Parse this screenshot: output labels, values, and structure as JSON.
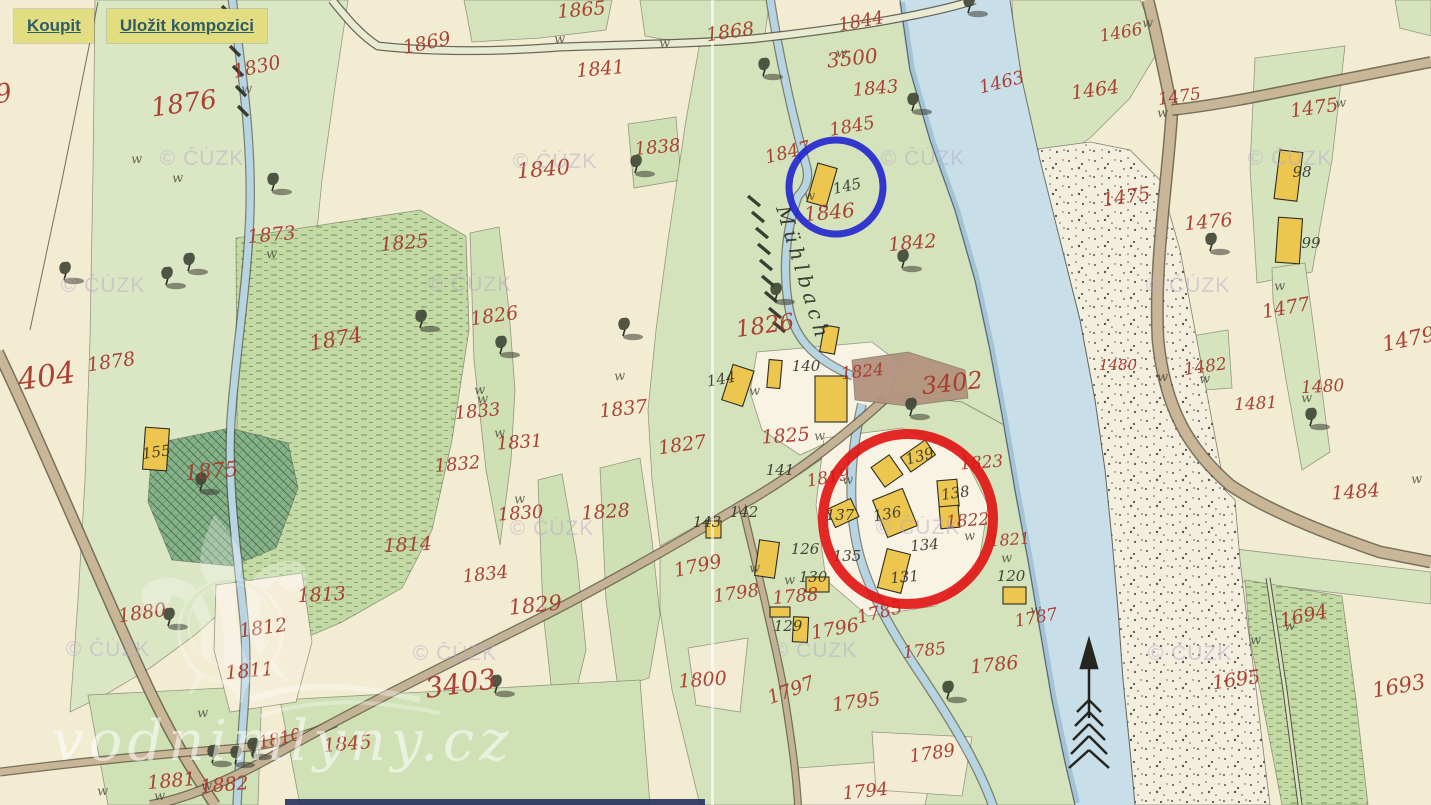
{
  "toolbar": {
    "buy_label": "Koupit",
    "save_label": "Uložit kompozici"
  },
  "map": {
    "stream_label": "Mühlbach",
    "watermark_small": "© ČÚZK",
    "watermark_large": "vodnimlyny.cz",
    "meadow_symbol": "w",
    "colors": {
      "annotation_blue": "#2023cf",
      "annotation_red": "#e01212",
      "parcel_red": "#a8392c",
      "building_yellow": "#ecc64e",
      "building_red": "#b34a56",
      "river_blue": "#c8dfe9"
    },
    "annotations": {
      "blue_circle": {
        "cx": 836,
        "cy": 187,
        "r": 47,
        "stroke_width": 7,
        "color": "#2023cf"
      },
      "red_circle": {
        "cx": 908,
        "cy": 519,
        "r": 85,
        "stroke_width": 10,
        "color": "#e01212"
      }
    },
    "red_parcels": [
      [
        "9",
        5,
        102,
        -10,
        26
      ],
      [
        "404",
        48,
        386,
        -8,
        30
      ],
      [
        "1876",
        185,
        112,
        -8,
        26
      ],
      [
        "1830",
        258,
        73,
        -12,
        19
      ],
      [
        "1873",
        272,
        241,
        -5,
        19
      ],
      [
        "1878",
        112,
        368,
        -8,
        19
      ],
      [
        "1875",
        212,
        478,
        -5,
        21
      ],
      [
        "1874",
        337,
        346,
        -10,
        21
      ],
      [
        "1880",
        143,
        619,
        -8,
        19
      ],
      [
        "1812",
        264,
        634,
        -8,
        19
      ],
      [
        "1811",
        250,
        677,
        -5,
        19
      ],
      [
        "1813",
        322,
        601,
        -3,
        19
      ],
      [
        "1881",
        172,
        787,
        -5,
        19
      ],
      [
        "1882",
        225,
        791,
        -5,
        19
      ],
      [
        "1810",
        281,
        744,
        -12,
        17
      ],
      [
        "3403",
        462,
        693,
        -8,
        28
      ],
      [
        "1845",
        348,
        750,
        -5,
        19
      ],
      [
        "1865",
        582,
        16,
        -5,
        19
      ],
      [
        "1869",
        428,
        49,
        -12,
        19
      ],
      [
        "1841",
        601,
        75,
        -5,
        19
      ],
      [
        "1868",
        731,
        38,
        -8,
        19
      ],
      [
        "1840",
        544,
        176,
        -5,
        21
      ],
      [
        "1838",
        658,
        153,
        -5,
        18
      ],
      [
        "1844",
        862,
        27,
        -10,
        18
      ],
      [
        "3500",
        853,
        65,
        -6,
        20
      ],
      [
        "1843",
        876,
        94,
        -5,
        18
      ],
      [
        "1845",
        853,
        132,
        -10,
        18
      ],
      [
        "1847",
        789,
        158,
        -14,
        18
      ],
      [
        "1846",
        830,
        219,
        -5,
        20
      ],
      [
        "1842",
        913,
        249,
        -5,
        19
      ],
      [
        "1825",
        405,
        249,
        -5,
        19
      ],
      [
        "1826",
        495,
        322,
        -8,
        19
      ],
      [
        "1826",
        766,
        333,
        -8,
        23
      ],
      [
        "1824",
        863,
        377,
        -6,
        17
      ],
      [
        "1825",
        786,
        442,
        -4,
        19
      ],
      [
        "1819",
        829,
        483,
        -10,
        17
      ],
      [
        "3402",
        953,
        391,
        -6,
        24
      ],
      [
        "1823",
        982,
        468,
        -4,
        17
      ],
      [
        "1822",
        968,
        526,
        -4,
        17
      ],
      [
        "1821",
        1010,
        545,
        -4,
        16
      ],
      [
        "1837",
        624,
        415,
        -6,
        19
      ],
      [
        "1827",
        683,
        451,
        -8,
        19
      ],
      [
        "1833",
        478,
        417,
        -5,
        18
      ],
      [
        "1831",
        520,
        448,
        -4,
        18
      ],
      [
        "1832",
        458,
        470,
        -5,
        18
      ],
      [
        "1830",
        521,
        519,
        -4,
        18
      ],
      [
        "1828",
        606,
        518,
        -4,
        19
      ],
      [
        "1834",
        486,
        580,
        -6,
        18
      ],
      [
        "1814",
        408,
        551,
        -3,
        19
      ],
      [
        "1829",
        536,
        612,
        -6,
        21
      ],
      [
        "1799",
        699,
        572,
        -12,
        19
      ],
      [
        "1798",
        737,
        599,
        -8,
        18
      ],
      [
        "1788",
        796,
        602,
        -5,
        18
      ],
      [
        "1796",
        836,
        635,
        -10,
        19
      ],
      [
        "1797",
        793,
        696,
        -20,
        19
      ],
      [
        "1795",
        857,
        708,
        -8,
        19
      ],
      [
        "1800",
        703,
        686,
        -4,
        19
      ],
      [
        "1785",
        881,
        618,
        -14,
        18
      ],
      [
        "1785",
        925,
        656,
        -6,
        17
      ],
      [
        "1786",
        995,
        671,
        -6,
        19
      ],
      [
        "1789",
        933,
        759,
        -8,
        18
      ],
      [
        "1794",
        866,
        797,
        -6,
        18
      ],
      [
        "1787",
        1037,
        623,
        -10,
        17
      ],
      [
        "1694",
        1305,
        622,
        -12,
        19
      ],
      [
        "1695",
        1237,
        686,
        -8,
        19
      ],
      [
        "1693",
        1400,
        693,
        -10,
        21
      ],
      [
        "1463",
        1003,
        88,
        -14,
        18
      ],
      [
        "1464",
        1096,
        96,
        -8,
        19
      ],
      [
        "1466",
        1122,
        38,
        -10,
        17
      ],
      [
        "1475",
        1180,
        102,
        -8,
        17
      ],
      [
        "1475",
        1315,
        114,
        -8,
        19
      ],
      [
        "1475",
        1127,
        203,
        -8,
        19
      ],
      [
        "1476",
        1209,
        228,
        -5,
        19
      ],
      [
        "1477",
        1287,
        314,
        -10,
        19
      ],
      [
        "1479",
        1410,
        346,
        -12,
        21
      ],
      [
        "1482",
        1206,
        372,
        -8,
        17
      ],
      [
        "1480",
        1118,
        370,
        0,
        15
      ],
      [
        "1480",
        1323,
        392,
        -3,
        17
      ],
      [
        "1481",
        1256,
        409,
        -3,
        17
      ],
      [
        "1484",
        1356,
        498,
        -4,
        19
      ]
    ],
    "black_numbers": [
      [
        "145",
        848,
        191,
        -12
      ],
      [
        "155",
        157,
        457,
        -8
      ],
      [
        "140",
        806,
        371,
        0
      ],
      [
        "144",
        722,
        384,
        -10
      ],
      [
        "141",
        780,
        475,
        0
      ],
      [
        "142",
        744,
        517,
        0
      ],
      [
        "143",
        707,
        527,
        0
      ],
      [
        "139",
        921,
        461,
        -15
      ],
      [
        "138",
        956,
        498,
        -8
      ],
      [
        "136",
        888,
        519,
        -10
      ],
      [
        "137",
        840,
        520,
        0
      ],
      [
        "135",
        847,
        561,
        0
      ],
      [
        "134",
        925,
        550,
        -5
      ],
      [
        "131",
        905,
        582,
        -5
      ],
      [
        "130",
        813,
        582,
        0
      ],
      [
        "126",
        805,
        554,
        0
      ],
      [
        "129",
        788,
        631,
        0
      ],
      [
        "120",
        1011,
        581,
        0
      ],
      [
        "98",
        1302,
        177,
        0
      ],
      [
        "99",
        1311,
        248,
        0
      ]
    ],
    "watermark_positions": [
      [
        147,
        165
      ],
      [
        48,
        292
      ],
      [
        500,
        168
      ],
      [
        415,
        291
      ],
      [
        868,
        165
      ],
      [
        863,
        534
      ],
      [
        760,
        657
      ],
      [
        1235,
        165
      ],
      [
        1133,
        292
      ],
      [
        1135,
        660
      ],
      [
        497,
        535
      ],
      [
        400,
        660
      ],
      [
        53,
        656
      ]
    ],
    "symbols": {
      "tree_positions": [
        [
          272,
          190
        ],
        [
          188,
          270
        ],
        [
          166,
          284
        ],
        [
          64,
          279
        ],
        [
          763,
          75
        ],
        [
          912,
          110
        ],
        [
          968,
          12
        ],
        [
          635,
          172
        ],
        [
          902,
          267
        ],
        [
          420,
          327
        ],
        [
          500,
          353
        ],
        [
          623,
          335
        ],
        [
          200,
          490
        ],
        [
          910,
          415
        ],
        [
          947,
          698
        ],
        [
          212,
          762
        ],
        [
          235,
          763
        ],
        [
          252,
          755
        ],
        [
          1210,
          250
        ],
        [
          1310,
          425
        ],
        [
          168,
          625
        ],
        [
          775,
          300
        ],
        [
          495,
          692
        ]
      ],
      "meadow_positions": [
        [
          178,
          182
        ],
        [
          247,
          93
        ],
        [
          272,
          258
        ],
        [
          137,
          163
        ],
        [
          483,
          403
        ],
        [
          500,
          437
        ],
        [
          520,
          503
        ],
        [
          560,
          43
        ],
        [
          665,
          47
        ],
        [
          842,
          57
        ],
        [
          620,
          380
        ],
        [
          480,
          394
        ],
        [
          820,
          440
        ],
        [
          755,
          572
        ],
        [
          790,
          584
        ],
        [
          970,
          540
        ],
        [
          1007,
          562
        ],
        [
          1036,
          614
        ],
        [
          1290,
          630
        ],
        [
          1256,
          644
        ],
        [
          1148,
          27
        ],
        [
          1163,
          117
        ],
        [
          1341,
          107
        ],
        [
          1163,
          381
        ],
        [
          1205,
          383
        ],
        [
          1307,
          402
        ],
        [
          1417,
          483
        ],
        [
          1280,
          290
        ],
        [
          203,
          717
        ],
        [
          255,
          757
        ],
        [
          103,
          795
        ],
        [
          160,
          800
        ],
        [
          207,
          790
        ],
        [
          810,
          200
        ],
        [
          848,
          484
        ],
        [
          755,
          395
        ]
      ]
    }
  }
}
